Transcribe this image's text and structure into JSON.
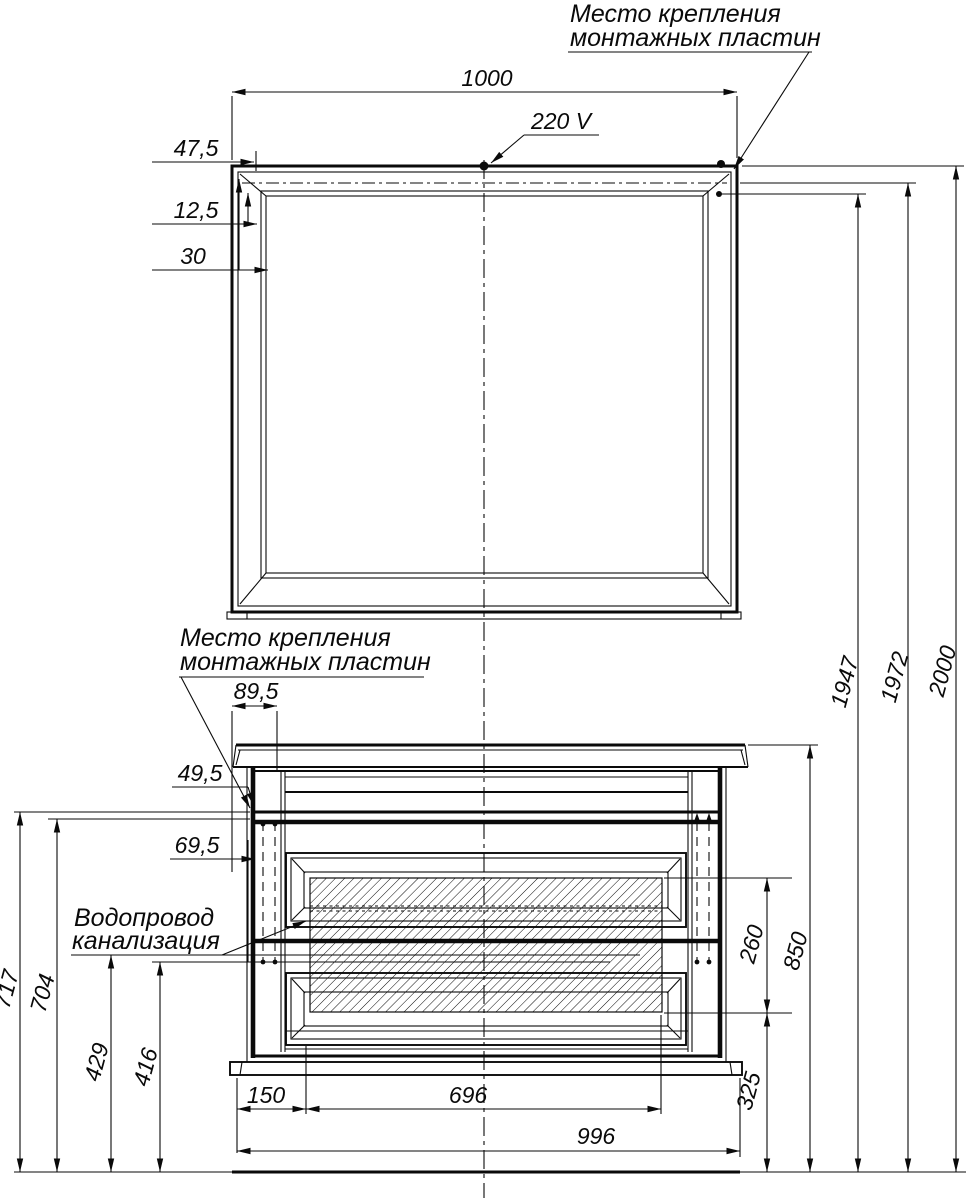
{
  "labels": {
    "mounting_top": {
      "l1": "Место крепления",
      "l2": "монтажных пластин"
    },
    "mounting_cabinet": {
      "l1": "Место крепления",
      "l2": "монтажных пластин"
    },
    "voltage": "220 V",
    "plumbing": {
      "l1": "Водопровод",
      "l2": "канализация"
    }
  },
  "dims": {
    "mirror_width": "1000",
    "top_offset": "47,5",
    "plate_offset": "12,5",
    "frame_depth": "30",
    "plate_width": "89,5",
    "rail_offset": "49,5",
    "side_offset": "69,5",
    "height_plates": "1947",
    "height_line": "1972",
    "height_total": "2000",
    "height_rail_a": "717",
    "height_rail_b": "704",
    "height_pipe_a": "429",
    "height_pipe_b": "416",
    "base_left": "150",
    "drawer_span": "696",
    "cabinet_width": "996",
    "hatch_height": "260",
    "cabinet_height": "850",
    "base_height": "325"
  },
  "colors": {
    "line": "#0a0a0a",
    "background": "#ffffff"
  }
}
